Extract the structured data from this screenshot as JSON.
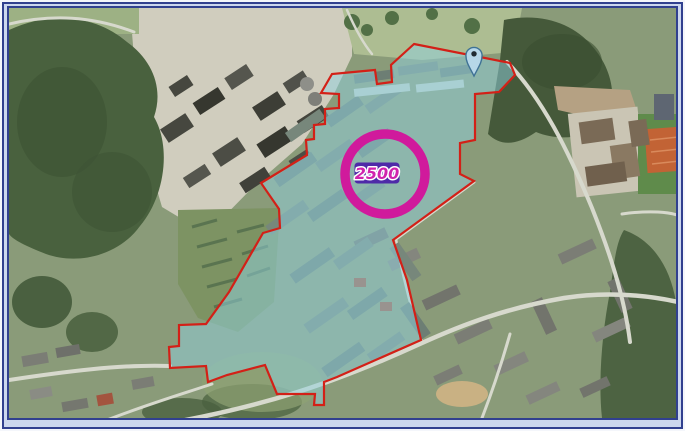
{
  "frame": {
    "border_color": "#31408f",
    "mat_color": "#ccd7ee"
  },
  "map": {
    "type": "aerial-imagery",
    "zone": {
      "outline_color": "#d32017",
      "fill_color": "#8fd2e0",
      "fill_opacity": "0.5",
      "points": "412,42 508,61 513,73 497,90 473,92 473,138 458,141 458,172 472,179 391,238 405,278 419,338 335,375 322,380 322,403 312,403 313,392 275,392 263,363 225,373 206,380 204,364 168,366 167,345 177,344 177,323 204,322 227,290 261,231 278,226 277,207 259,181 305,153 304,138 312,137 312,123 323,122 323,107 337,106 337,92 319,91 330,72 373,68 375,82 390,80 389,63"
    },
    "radius_annotation": {
      "value": "2500",
      "ring_color": "#d01a9c",
      "ring_width": "9.5",
      "cx": "383",
      "cy": "172",
      "r": "40",
      "label_bg": "#4e2aa8",
      "label_text_color": "#d023ae"
    },
    "marker": {
      "type": "location-pin",
      "fill": "#b6d7e8",
      "outline": "#3f7295"
    }
  }
}
